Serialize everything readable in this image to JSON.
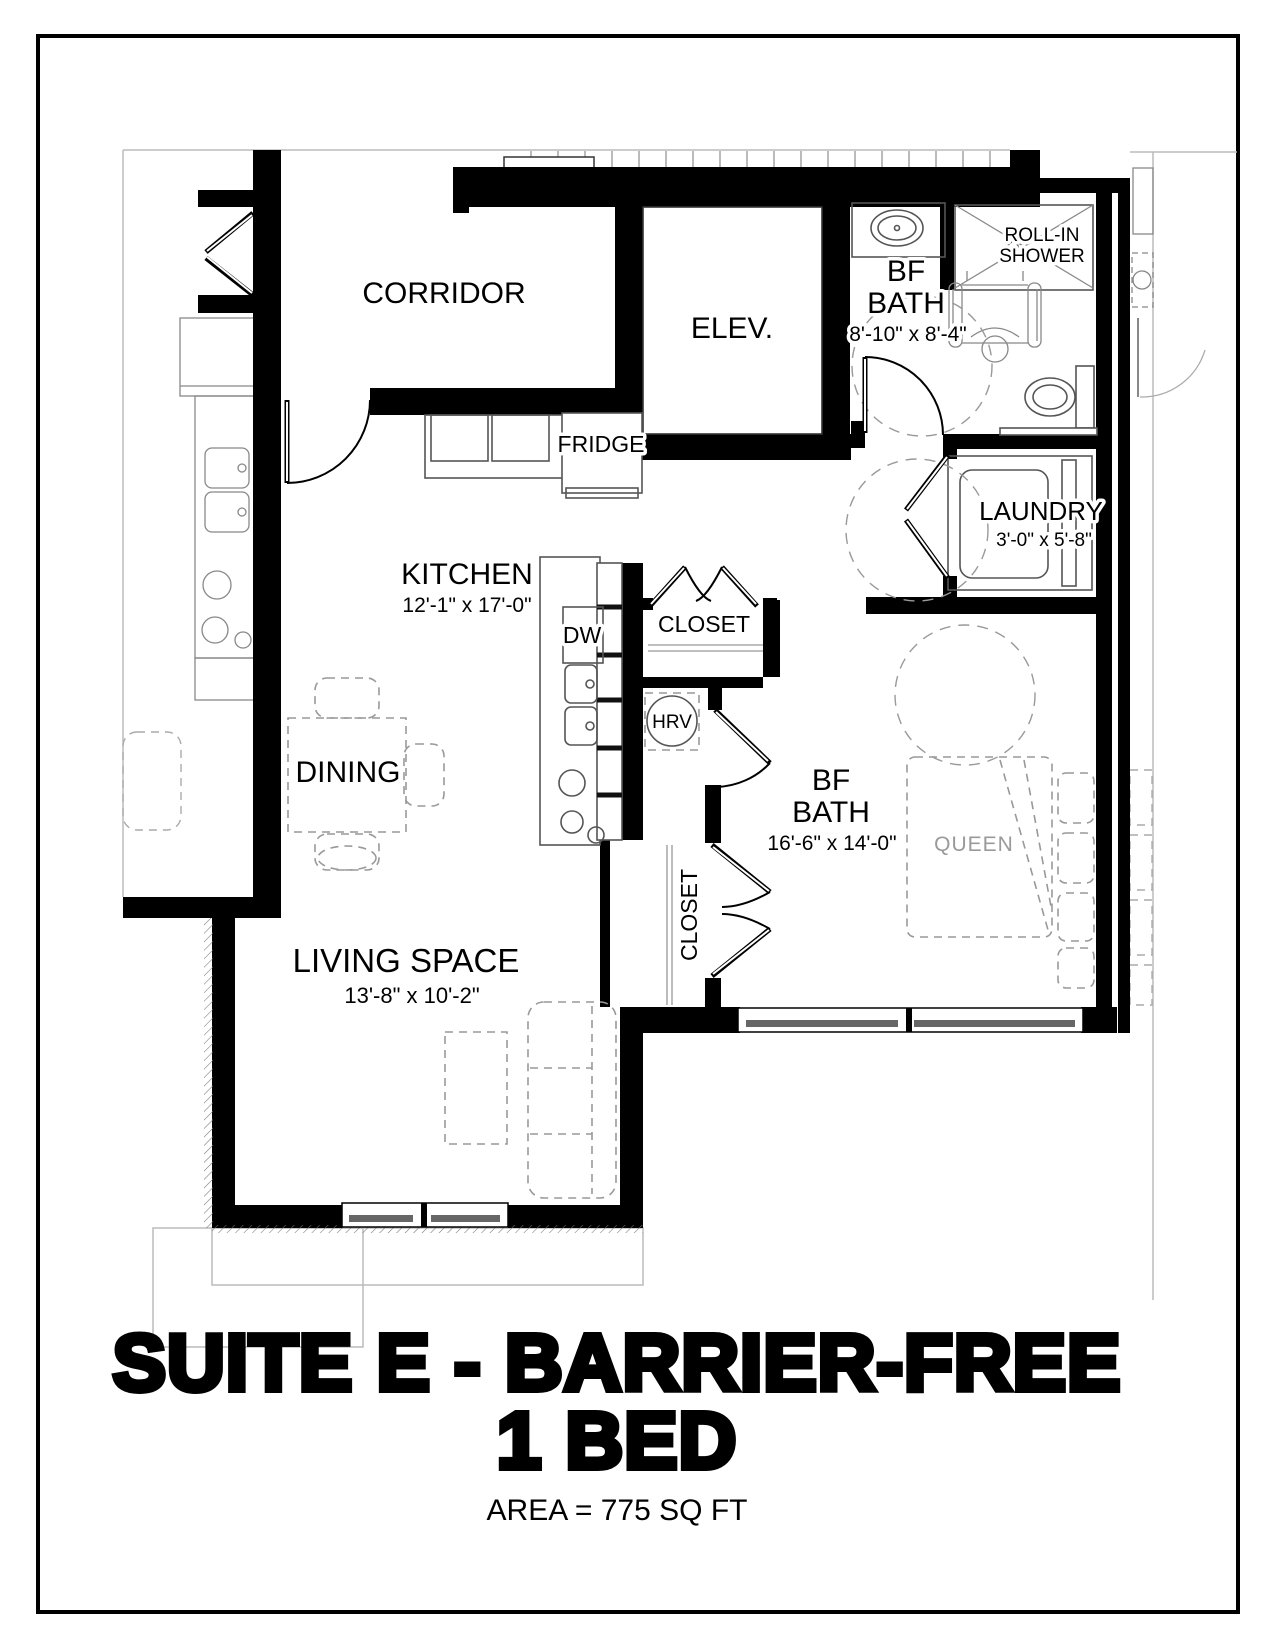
{
  "sheet": {
    "title_block": {
      "line1": "SUITE E - BARRIER-FREE",
      "line2": "1 BED",
      "area": "AREA = 775 SQ FT"
    },
    "rooms": {
      "corridor": {
        "name": "CORRIDOR"
      },
      "elevator": {
        "name": "ELEV."
      },
      "bf_bath": {
        "line1": "BF",
        "line2": "BATH",
        "dims": "8'-10\" x 8'-4\""
      },
      "roll_in_shower": {
        "line1": "ROLL-IN",
        "line2": "SHOWER"
      },
      "laundry": {
        "name": "LAUNDRY",
        "dims": "3'-0\" x 5'-8\""
      },
      "kitchen": {
        "name": "KITCHEN",
        "dims": "12'-1\" x 17'-0\""
      },
      "dining": {
        "name": "DINING"
      },
      "bedroom": {
        "line1": "BF",
        "line2": "BATH",
        "dims": "16'-6\" x 14'-0\""
      },
      "living": {
        "name": "LIVING SPACE",
        "dims": "13'-8\" x 10'-2\""
      }
    },
    "fixtures": {
      "fridge": "FRIDGE",
      "dishwasher": "DW",
      "hall_closet": "CLOSET",
      "hrv": "HRV",
      "bedroom_closet": "CLOSET",
      "bed": "QUEEN"
    },
    "colors": {
      "walls": "#000000",
      "fixtures": "#555555",
      "furniture_dash": "#999999",
      "adjacent_light": "#bbbbbb"
    }
  }
}
